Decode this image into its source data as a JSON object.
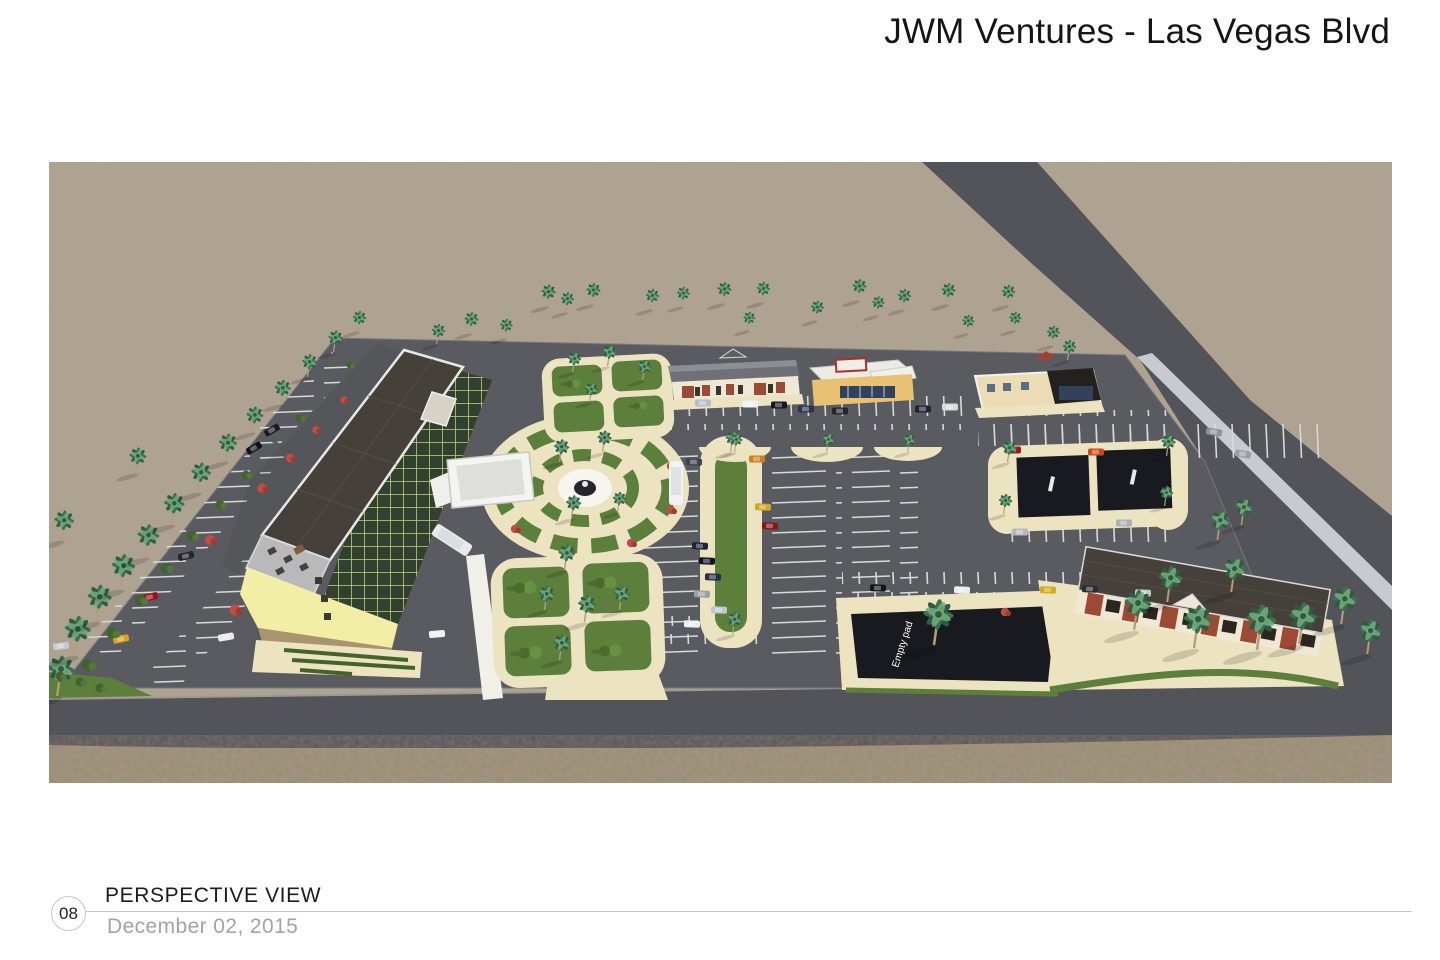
{
  "header": {
    "title": "JWM Ventures - Las Vegas Blvd"
  },
  "rendering": {
    "description": "Aerial perspective rendering of proposed development: hotel with porte-cochere, fountain plaza, landscaped gardens, retail pads, parking lots with palm trees, boulevard at right, desert surroundings",
    "empty_pad_label": "Empty pad"
  },
  "footer": {
    "page_number": "08",
    "view_label": "PERSPECTIVE VIEW",
    "date": "December 02, 2015"
  },
  "colors": {
    "desert": "#b1a593",
    "gravel": "#a5977f",
    "road": "#53545a",
    "asphalt": "#5a5b61",
    "curb": "#ece3c1",
    "lawn": "#5d7f3c",
    "lawn_dark": "#44632c",
    "roof_dark": "#46403a",
    "roof_gray": "#707177",
    "wall_yellow": "#f2eea6",
    "wall_cream": "#efe8d4",
    "brick": "#9c4a33",
    "canopy": "#f4f4f0",
    "pad_dark": "#191a20",
    "window_dark": "#32402f",
    "window_grid": "#c9d47d",
    "storefront": "#32415c",
    "road_stripe": "#c7cad0",
    "palm_green": "#3c7150",
    "palm_light": "#74ac80",
    "trunk": "#b59d7c",
    "flower_red": "#bf4f46"
  }
}
